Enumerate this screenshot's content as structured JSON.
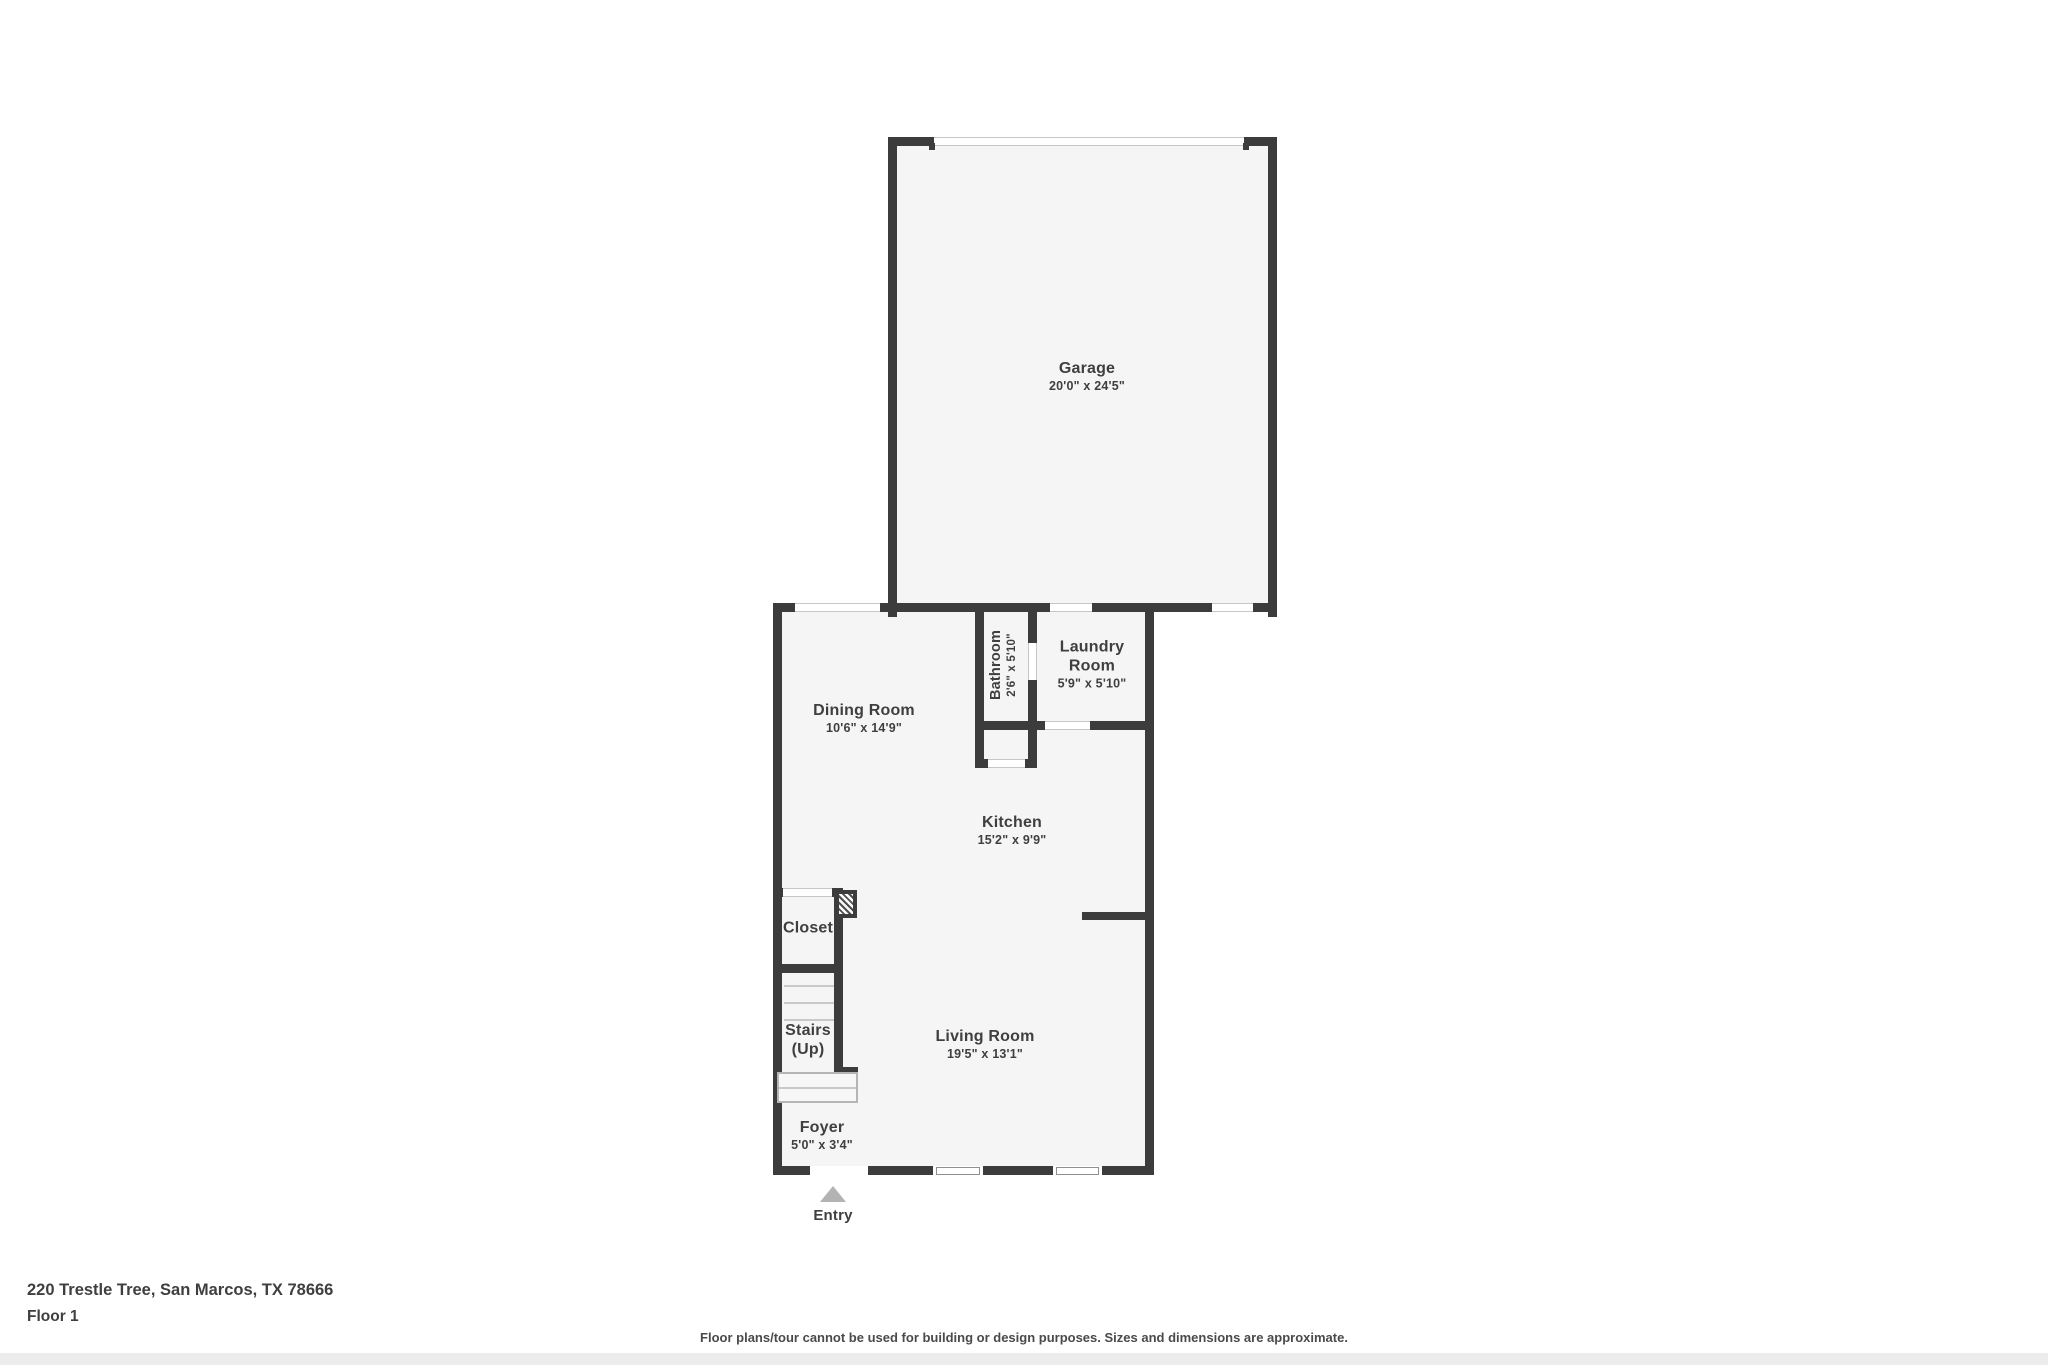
{
  "colors": {
    "wall": "#3c3c3c",
    "floor": "#f5f5f5",
    "text": "#3f3f3f",
    "line": "#c9c9c9",
    "arrow": "#b3b3b3"
  },
  "rooms": {
    "garage": {
      "name": "Garage",
      "dims": "20'0\" x 24'5\""
    },
    "laundry": {
      "name": "Laundry Room",
      "dims": "5'9\" x 5'10\""
    },
    "bathroom": {
      "name": "Bathroom",
      "dims": "2'6\" x 5'10\""
    },
    "dining": {
      "name": "Dining Room",
      "dims": "10'6\" x 14'9\""
    },
    "kitchen": {
      "name": "Kitchen",
      "dims": "15'2\" x 9'9\""
    },
    "closet": {
      "name": "Closet"
    },
    "stairs": {
      "name": "Stairs",
      "sub": "(Up)"
    },
    "living": {
      "name": "Living Room",
      "dims": "19'5\" x 13'1\""
    },
    "foyer": {
      "name": "Foyer",
      "dims": "5'0\" x 3'4\""
    }
  },
  "entry": {
    "label": "Entry"
  },
  "footer": {
    "address": "220 Trestle Tree, San Marcos, TX 78666",
    "floor_label": "Floor 1",
    "disclaimer": "Floor plans/tour cannot be used for building or design purposes. Sizes and dimensions are approximate."
  }
}
